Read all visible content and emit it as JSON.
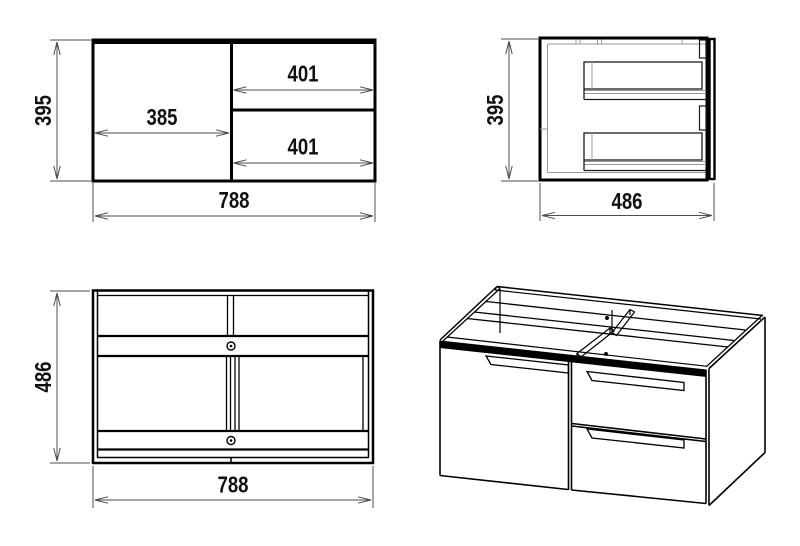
{
  "canvas": {
    "width": 800,
    "height": 546,
    "background": "#ffffff"
  },
  "colors": {
    "outline": "#000000",
    "dimension_line": "#4d4d4d",
    "inner_detail": "#999999",
    "text": "#111111"
  },
  "views": {
    "front_view": {
      "height": "395",
      "width": "788",
      "door_width": "385",
      "upper_drawer_width": "401",
      "lower_drawer_width": "401"
    },
    "side_view": {
      "height": "395",
      "depth": "486"
    },
    "top_view": {
      "depth": "486",
      "width": "788"
    }
  }
}
